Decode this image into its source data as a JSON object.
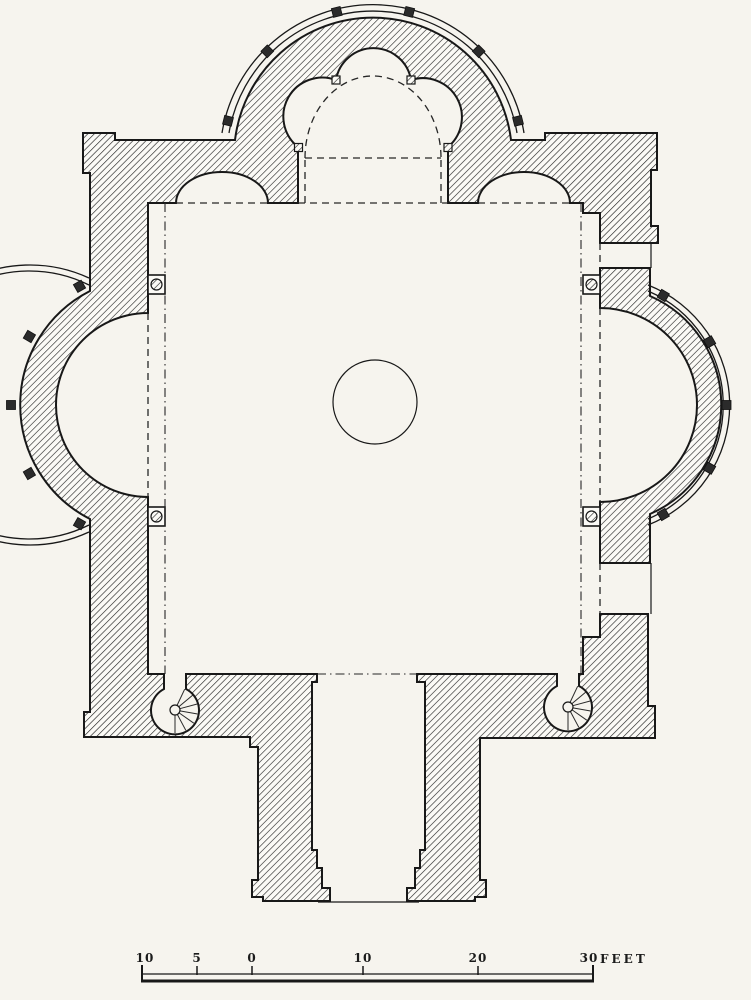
{
  "figure": {
    "kind": "architectural-floor-plan",
    "description": "Plan of a square chapel with a trefoil north apse, two lateral semicircular apses, two newel staircases and a south entrance porch"
  },
  "colors": {
    "paper": "#f6f4ee",
    "ink": "#181818",
    "hatch_line": "#222222"
  },
  "scale_bar": {
    "labels": [
      {
        "text": "10"
      },
      {
        "text": "5"
      },
      {
        "text": "0"
      },
      {
        "text": "10"
      },
      {
        "text": "20"
      },
      {
        "text": "30"
      }
    ],
    "unit": "FEET"
  }
}
